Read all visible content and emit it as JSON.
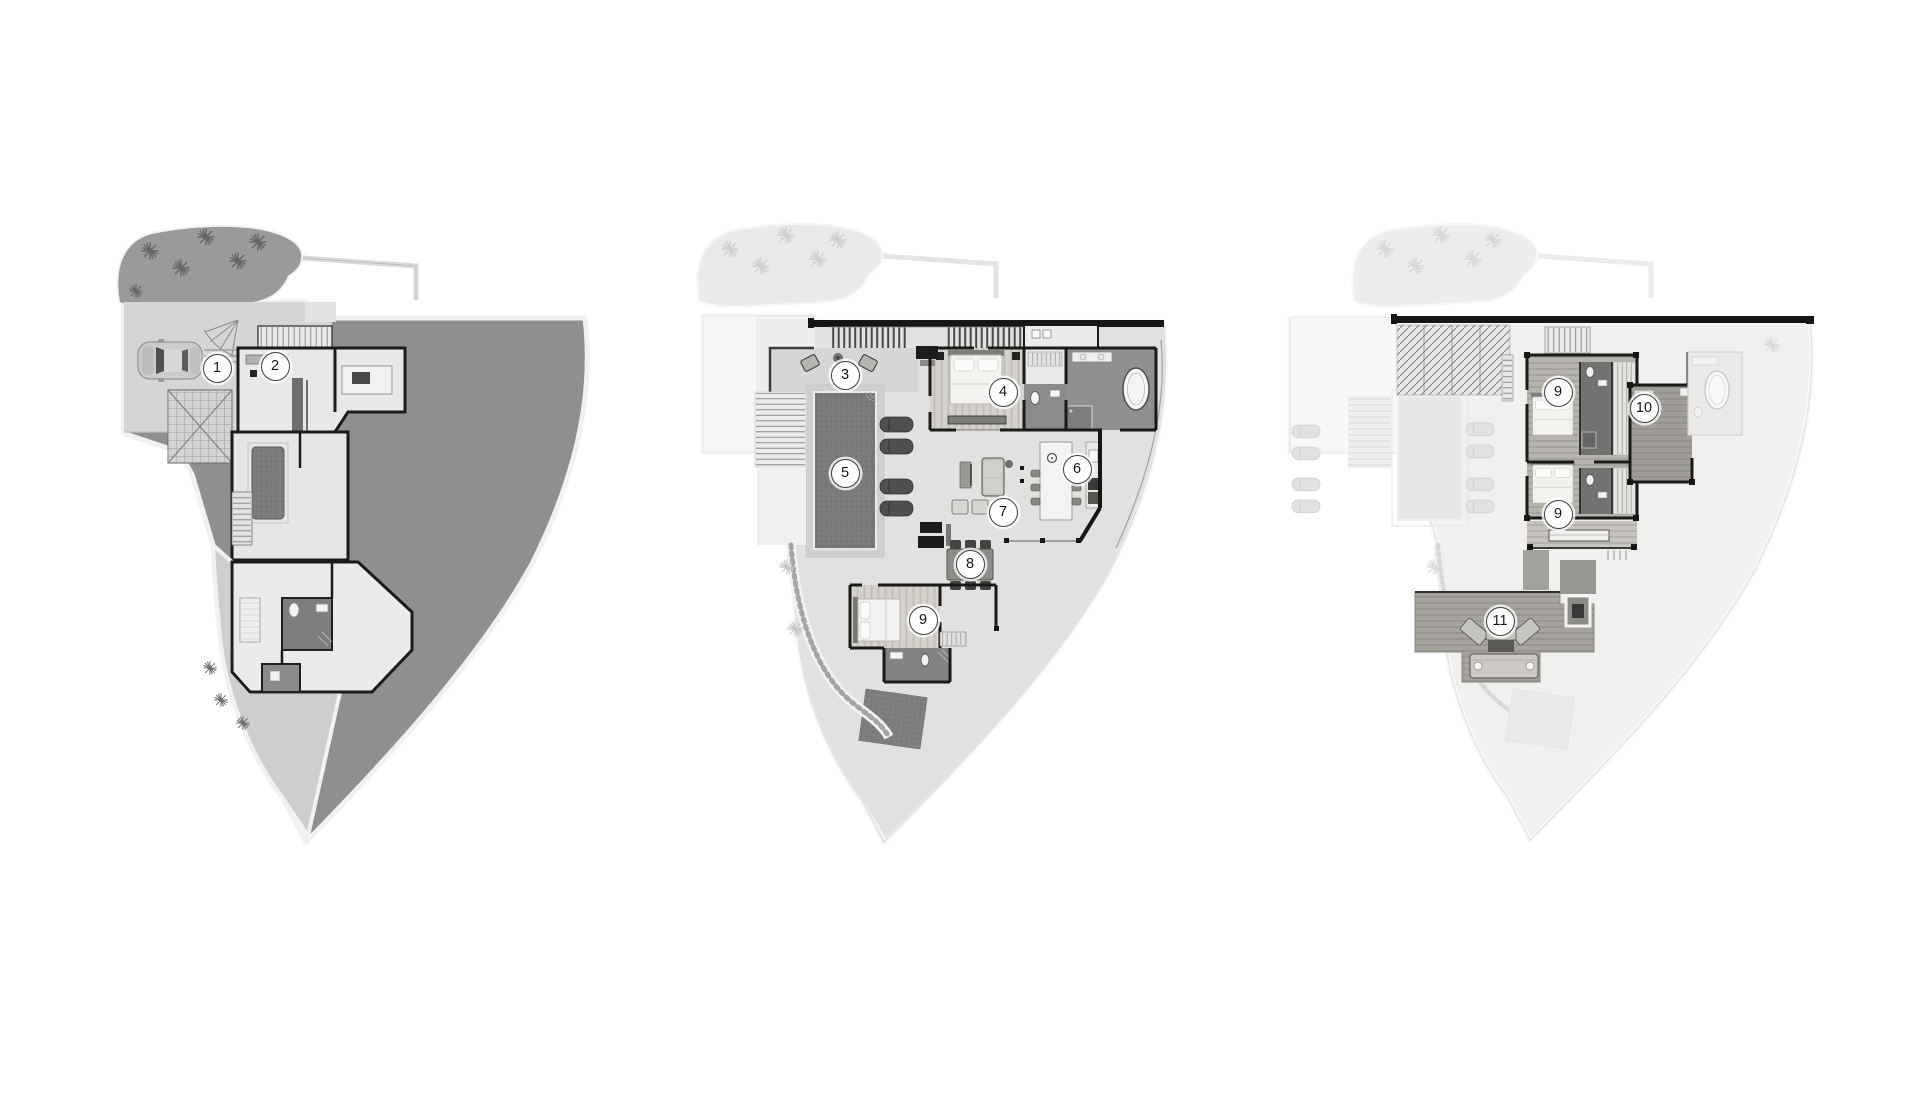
{
  "page": {
    "background": "#ffffff"
  },
  "palette": {
    "terrain_dark": "#8f8f8f",
    "garden_dark": "#9a9a9a",
    "wall_black": "#1a1a1a",
    "pool_water": "#7b7b79",
    "floor_light": "#e2e1df",
    "ghost_light": "#f0efed",
    "marker_bg": "#ffffff",
    "marker_border": "#3f3f3f",
    "marker_text": "#161616"
  },
  "plans": [
    {
      "id": "lower-level-site-plan",
      "markers": [
        {
          "label": "1",
          "x": 216,
          "y": 367
        },
        {
          "label": "2",
          "x": 274,
          "y": 365
        }
      ]
    },
    {
      "id": "main-level-plan",
      "markers": [
        {
          "label": "3",
          "x": 844,
          "y": 374
        },
        {
          "label": "4",
          "x": 1002,
          "y": 391
        },
        {
          "label": "5",
          "x": 844,
          "y": 472
        },
        {
          "label": "6",
          "x": 1076,
          "y": 468
        },
        {
          "label": "7",
          "x": 1002,
          "y": 511
        },
        {
          "label": "8",
          "x": 969,
          "y": 563
        },
        {
          "label": "9",
          "x": 922,
          "y": 619
        }
      ]
    },
    {
      "id": "upper-level-plan",
      "markers": [
        {
          "label": "9",
          "x": 1557,
          "y": 391
        },
        {
          "label": "10",
          "x": 1643,
          "y": 407
        },
        {
          "label": "9",
          "x": 1557,
          "y": 513
        },
        {
          "label": "11",
          "x": 1499,
          "y": 620
        }
      ]
    }
  ]
}
